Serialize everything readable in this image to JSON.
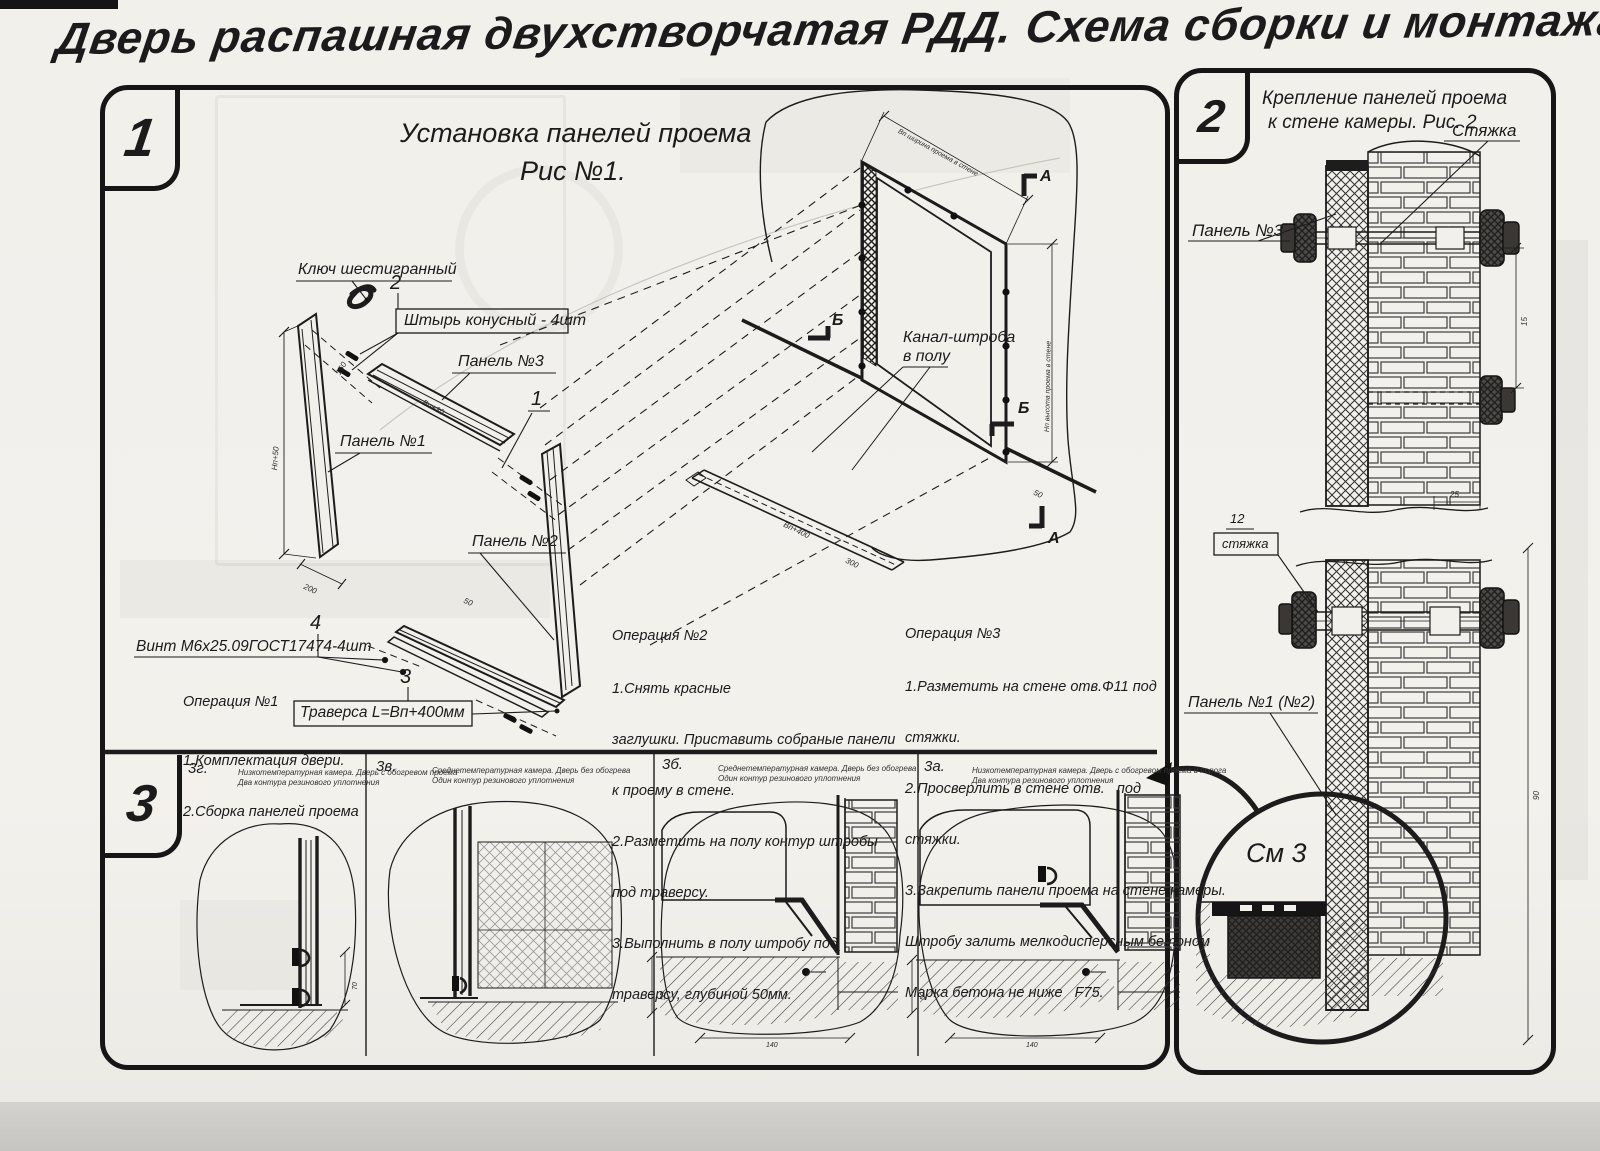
{
  "page": {
    "title": "Дверь распашная двухстворчатая РДД.  Схема сборки и монтажа №2"
  },
  "panel1": {
    "badge": "1",
    "title_line1": "Установка панелей проема",
    "title_line2": "Рис №1.",
    "labels": {
      "hex_key": "Ключ шестигранный",
      "pin": "Штырь конусный - 4шт",
      "p3": "Панель №3",
      "p1": "Панель №1",
      "p2": "Панель №2",
      "screw": "Винт М6х25.09ГОСТ17474-4шт",
      "traverse": "Траверса  L=Вп+400мм",
      "channel1": "Канал-штроба",
      "channel2": "в полу",
      "b1": "1",
      "b2": "2",
      "b3": "3",
      "b4": "4",
      "mA": "А",
      "mB": "Б"
    },
    "dims": {
      "d_h": "Нп+50",
      "d_200": "200",
      "d_w": "Вп+30",
      "d_160": "160",
      "d_50": "50",
      "d_bp400": "Вп+400",
      "d_300": "300",
      "d_50b": "50",
      "d_wallw": "Вп ширина проема в стене",
      "d_wallh": "Нп высота проема в стене"
    },
    "op1": {
      "title": "Операция №1",
      "lines": [
        "1.Комплектация двери.",
        "2.Сборка панелей проема"
      ]
    },
    "op2": {
      "title": "Операция №2",
      "lines": [
        "1.Снять красные",
        "заглушки. Приставить собраные панели",
        "к проему в стене.",
        "2.Разметить на полу контур штробы",
        "под траверсу.",
        "3.Выполнить в полу штробу под",
        "траверсу, глубиной 50мм."
      ]
    },
    "op3": {
      "title": "Операция №3",
      "lines": [
        "1.Разметить на стене отв.Ф11 под",
        "стяжки.",
        "2.Просверлить в стене отв.   под",
        "стяжки.",
        "3.Закрепить панели проема на стене камеры.",
        "Штробу залить мелкодисперсным бетоном",
        "Марка бетона не ниже   F75."
      ]
    }
  },
  "strip": {
    "badge": "3",
    "g": {
      "code": "3г.",
      "cap1": "Низкотемпературная камера. Дверь с обогревом проема",
      "cap2": "Два контура резинового уплотнения",
      "d70": "70"
    },
    "v": {
      "code": "3в.",
      "cap1": "Среднетемпературная камера. Дверь без обогрева",
      "cap2": "Один контур резинового уплотнения"
    },
    "b": {
      "code": "3б.",
      "cap1": "Среднетемпературная камера. Дверь без обогрева",
      "cap2": "Один контур резинового уплотнения",
      "d50": "50",
      "d140": "140"
    },
    "a": {
      "code": "3а.",
      "cap1": "Низкотемпературная камера. Дверь с обогревом проема и порога",
      "cap2": "Два контура резинового уплотнения",
      "d50": "50",
      "d140": "140"
    }
  },
  "panel2": {
    "badge": "2",
    "title_line1": "Крепление панелей проема",
    "title_line2": "к стене камеры. Рис. 2",
    "labels": {
      "tie": "Стяжка",
      "p3": "Панель №3",
      "n12": "12",
      "tie_small": "стяжка",
      "p12": "Панель №1 (№2)",
      "see3": "См 3"
    },
    "dims": {
      "d15": "15",
      "d25": "25",
      "d90": "90"
    }
  },
  "colors": {
    "ink": "#1c1c1c",
    "paper": "#f2f0eb"
  }
}
